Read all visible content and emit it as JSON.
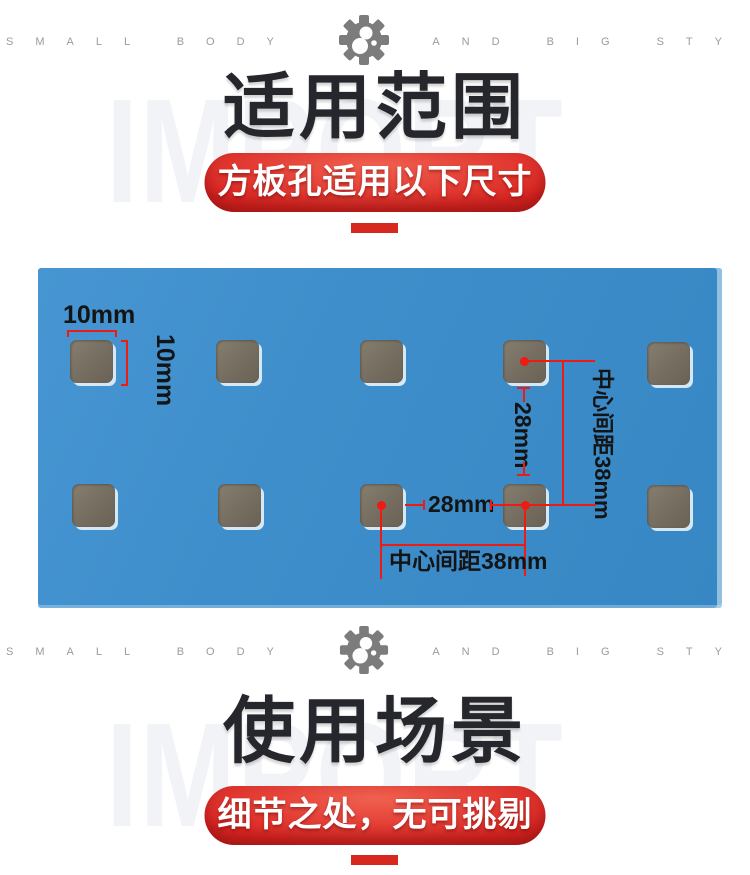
{
  "tagline": {
    "left": "SMALL BODY",
    "right": "AND BIG STY"
  },
  "watermark": "IMPORT",
  "sections": {
    "range": {
      "title": "适用范围",
      "banner": "方板孔适用以下尺寸"
    },
    "usage": {
      "title": "使用场景",
      "banner": "细节之处，无可挑剔"
    }
  },
  "diagram": {
    "hole_width_label": "10mm",
    "hole_height_label": "10mm",
    "vertical_gap_label": "28mm",
    "horizontal_gap_label": "28mm",
    "vertical_center_distance_label": "中心间距38mm",
    "horizontal_center_distance_label": "中心间距38mm"
  },
  "colors": {
    "accent_red": "#d7281f",
    "banner_red": "#da2522",
    "board_blue": "#3e8ecb",
    "hole_gray": "#756d5f",
    "annotation_red": "#ee1b15",
    "title_dark": "#25272c",
    "watermark_gray": "#f2f3f7",
    "tagline_gray": "#9b9b9b"
  }
}
